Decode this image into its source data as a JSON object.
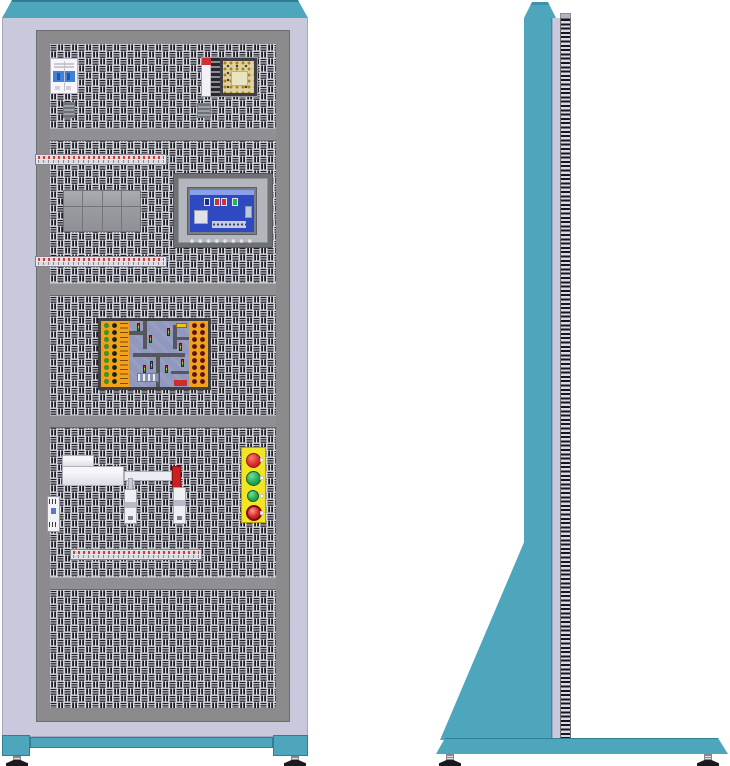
{
  "colors": {
    "cabinet-teal": "#4da6bb",
    "cabinet-teal-dark": "#2f7e93",
    "cabinet-lavender": "#c9c9dd",
    "frame-gray": "#8b8b8d",
    "panel-bg": "#dadae6",
    "panel-hole": "#1c1c20",
    "divider-gray": "#909094",
    "hmi-screen-blue": "#2f49c0",
    "board-orange": "#f2a21a",
    "button-yellow": "#f2e526",
    "signal-red": "#cf2127",
    "signal-green": "#1f9d4c",
    "rod-tip-red": "#cc2020",
    "foot-black": "#1a1a1e"
  },
  "front_view": {
    "sections": [
      {
        "components": [
          "miniature-circuit-breaker",
          "switching-power-supply",
          "din-clip",
          "din-clip"
        ]
      },
      {
        "components": [
          "terminal-strip",
          "plc-module-block",
          "hmi-touch-panel",
          "terminal-strip"
        ]
      },
      {
        "components": [
          "traffic-intersection-trainer-board"
        ]
      },
      {
        "components": [
          "pneumatic-cylinder",
          "relay-module",
          "solenoid-valve",
          "solenoid-valve",
          "push-button-station",
          "terminal-strip"
        ]
      },
      {
        "components": []
      }
    ],
    "push_button_station": {
      "buttons": [
        {
          "color": "red",
          "type": "push-button"
        },
        {
          "color": "green",
          "type": "push-button"
        },
        {
          "color": "green",
          "type": "push-button"
        },
        {
          "color": "red",
          "type": "emergency-stop"
        }
      ]
    },
    "terminal_strip_count": 3,
    "plc_module_cells": 8,
    "hmi_function_keys": 8,
    "leveling_feet": 2
  },
  "side_view": {
    "parts": [
      "top-cap",
      "column",
      "perforated-edge",
      "support-gusset",
      "floor-base"
    ],
    "leveling_feet": 2
  }
}
